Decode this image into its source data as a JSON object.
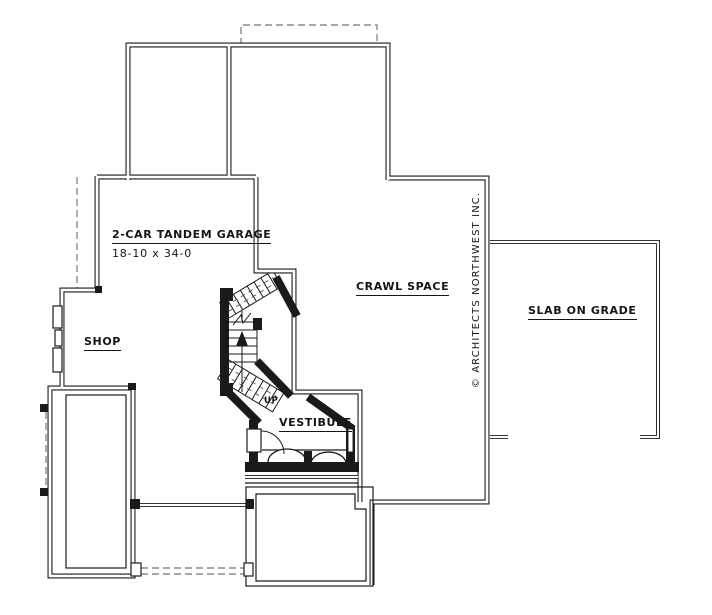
{
  "plan": {
    "garage": {
      "title": "2-CAR TANDEM GARAGE",
      "dims": "18-10 x 34-0"
    },
    "rooms": {
      "crawl": "CRAWL SPACE",
      "slab": "SLAB ON GRADE",
      "shop": "SHOP",
      "vestibule": "VESTIBULE"
    },
    "stairs_up": "UP",
    "copyright": "© ARCHITECTS NORTHWEST INC.",
    "colors": {
      "line": "#1a1a1a",
      "dash": "#8c8c8c",
      "background": "#ffffff"
    }
  }
}
